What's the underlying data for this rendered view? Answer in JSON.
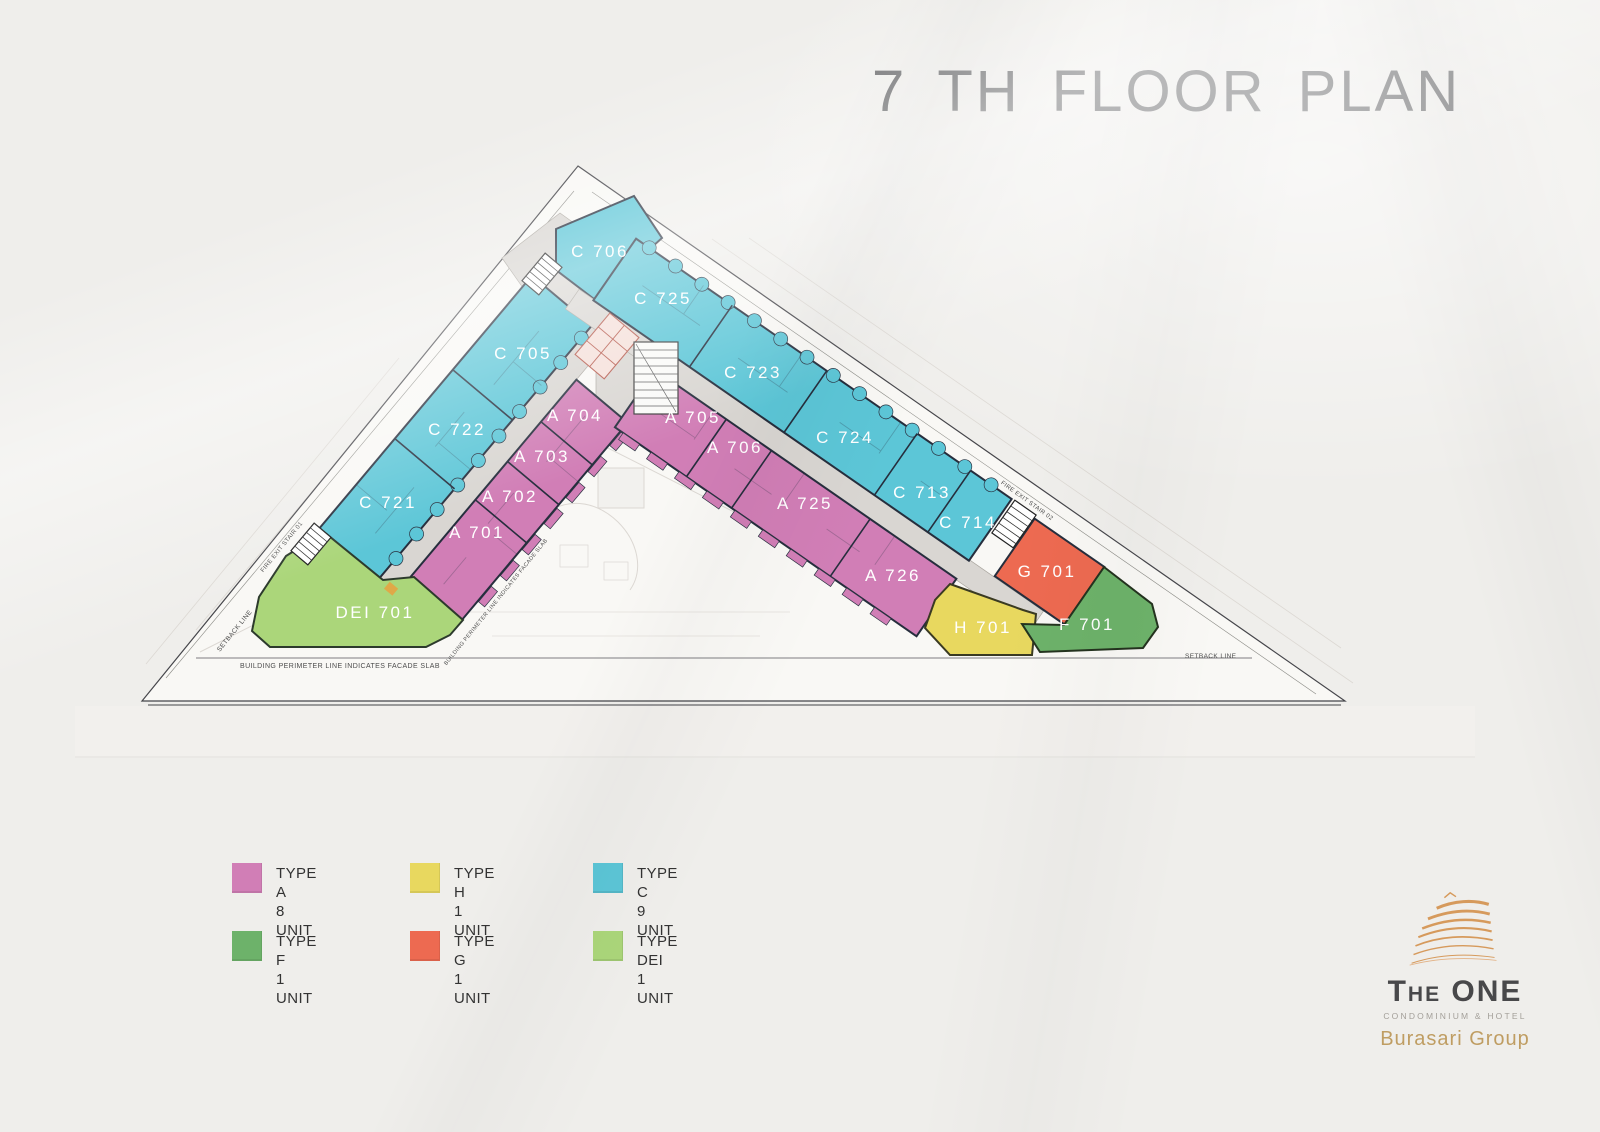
{
  "page": {
    "title": "7 TH  FLOOR PLAN"
  },
  "plan": {
    "units": [
      {
        "label": "C 706",
        "type": "C"
      },
      {
        "label": "C 725",
        "type": "C"
      },
      {
        "label": "C 705",
        "type": "C"
      },
      {
        "label": "C 723",
        "type": "C"
      },
      {
        "label": "C 722",
        "type": "C"
      },
      {
        "label": "A 704",
        "type": "A"
      },
      {
        "label": "A 705",
        "type": "A"
      },
      {
        "label": "A 706",
        "type": "A"
      },
      {
        "label": "C 724",
        "type": "C"
      },
      {
        "label": "A 703",
        "type": "A"
      },
      {
        "label": "A 702",
        "type": "A"
      },
      {
        "label": "C 721",
        "type": "C"
      },
      {
        "label": "A 701",
        "type": "A"
      },
      {
        "label": "A 725",
        "type": "A"
      },
      {
        "label": "C 713",
        "type": "C"
      },
      {
        "label": "C 714",
        "type": "C"
      },
      {
        "label": "A 726",
        "type": "A"
      },
      {
        "label": "G 701",
        "type": "G"
      },
      {
        "label": "DEI 701",
        "type": "DEI"
      },
      {
        "label": "H 701",
        "type": "H"
      },
      {
        "label": "F 701",
        "type": "F"
      }
    ],
    "annotations": {
      "fire_exit_1": "FIRE EXIT STAIR 01",
      "fire_exit_2": "FIRE EXIT STAIR 02",
      "setback_left": "SETBACK LINE",
      "setback_right": "SETBACK LINE",
      "perimeter_note_bottom": "BUILDING PERIMETER LINE INDICATES FACADE SLAB",
      "perimeter_note_diagonal": "BUILDING PERIMETER LINE INDICATES FACADE SLAB"
    },
    "colors": {
      "type_a": "#d17eb6",
      "type_h": "#e8d85f",
      "type_c": "#5cc6d7",
      "type_f": "#6db26a",
      "type_g": "#ed6a51",
      "type_dei": "#abd67a",
      "corridor": "#d9d6d2",
      "walls": "#262e3d"
    }
  },
  "legend": {
    "items": [
      {
        "label": "TYPE A",
        "units": "8 UNIT",
        "color": "#d17eb6"
      },
      {
        "label": "TYPE H",
        "units": "1 UNIT",
        "color": "#e8d85f"
      },
      {
        "label": "TYPE C",
        "units": "9 UNIT",
        "color": "#5cc6d7"
      },
      {
        "label": "TYPE F",
        "units": "1 UNIT",
        "color": "#6db26a"
      },
      {
        "label": "TYPE G",
        "units": "1 UNIT",
        "color": "#ed6a51"
      },
      {
        "label": "TYPE DEI",
        "units": "1 UNIT",
        "color": "#abd67a"
      }
    ]
  },
  "logo": {
    "name": "The ONE",
    "tagline": "CONDOMINIUM & HOTEL",
    "group": "Burasari Group"
  }
}
